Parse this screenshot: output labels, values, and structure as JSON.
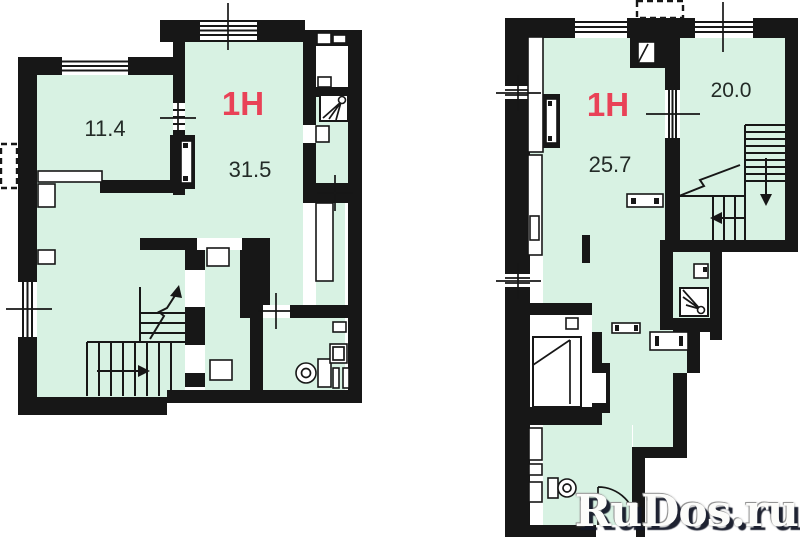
{
  "page": {
    "background": "#ffffff"
  },
  "colors": {
    "wall": "#171717",
    "room_fill": "#d8f2e3",
    "accent_red": "#e94257",
    "label_text": "#232b27",
    "watermark_text": "#fcfcfa",
    "watermark_shadow": "#121626"
  },
  "plans": [
    {
      "name": "lower-level-plan",
      "unit_label": "1H",
      "rooms": [
        {
          "area": "11.4"
        },
        {
          "area": "31.5"
        }
      ],
      "icons": [
        "window-icon",
        "stairs-up-icon",
        "stairs-down-icon",
        "door-icon",
        "toilet-icon",
        "shower-icon",
        "sink-icon",
        "axis-cross-icon",
        "dashed-annex-icon"
      ]
    },
    {
      "name": "upper-level-plan",
      "unit_label": "1H",
      "rooms": [
        {
          "area": "25.7"
        },
        {
          "area": "20.0"
        }
      ],
      "icons": [
        "window-icon",
        "stairs-down-icon",
        "door-swing-icon",
        "toilet-icon",
        "shower-icon",
        "sink-icon",
        "bed-icon",
        "wardrobe-icon",
        "axis-cross-icon",
        "dashed-annex-icon"
      ]
    }
  ],
  "watermark": {
    "text": "RuDos.ru"
  }
}
